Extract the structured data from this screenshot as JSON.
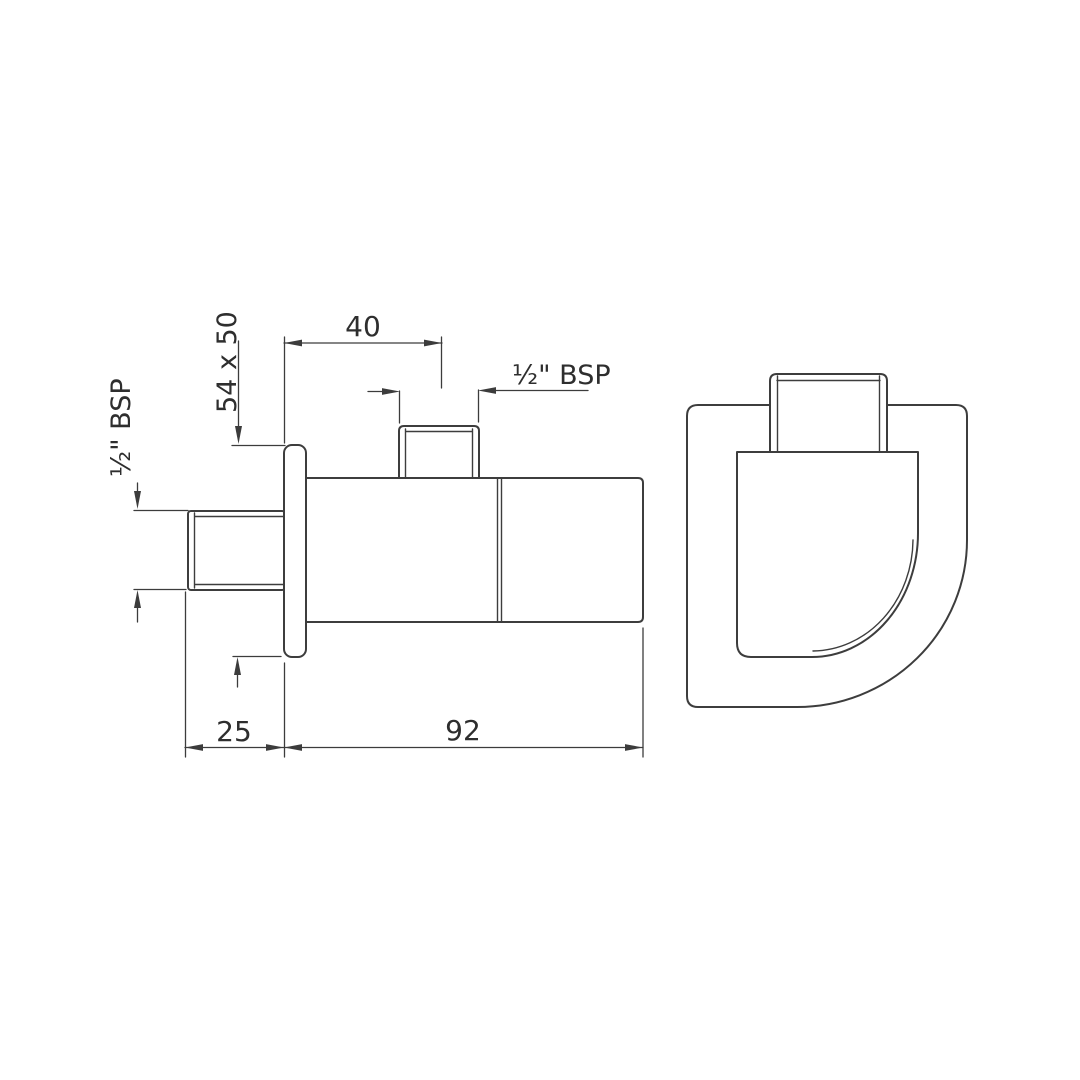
{
  "meta": {
    "background": "#ffffff",
    "line_color": "#3d3d3d",
    "text_color": "#2e2e2e",
    "description": "CAD dimension drawing of a wall-mounted angle valve: side view with dimensions and front view"
  },
  "drawing": {
    "dimensions": {
      "outlet_offset": "40",
      "flange_size": "54 x 50",
      "inlet_thread": "½\" BSP",
      "outlet_thread": "½\" BSP",
      "wall_projection": "25",
      "body_length": "92"
    }
  }
}
